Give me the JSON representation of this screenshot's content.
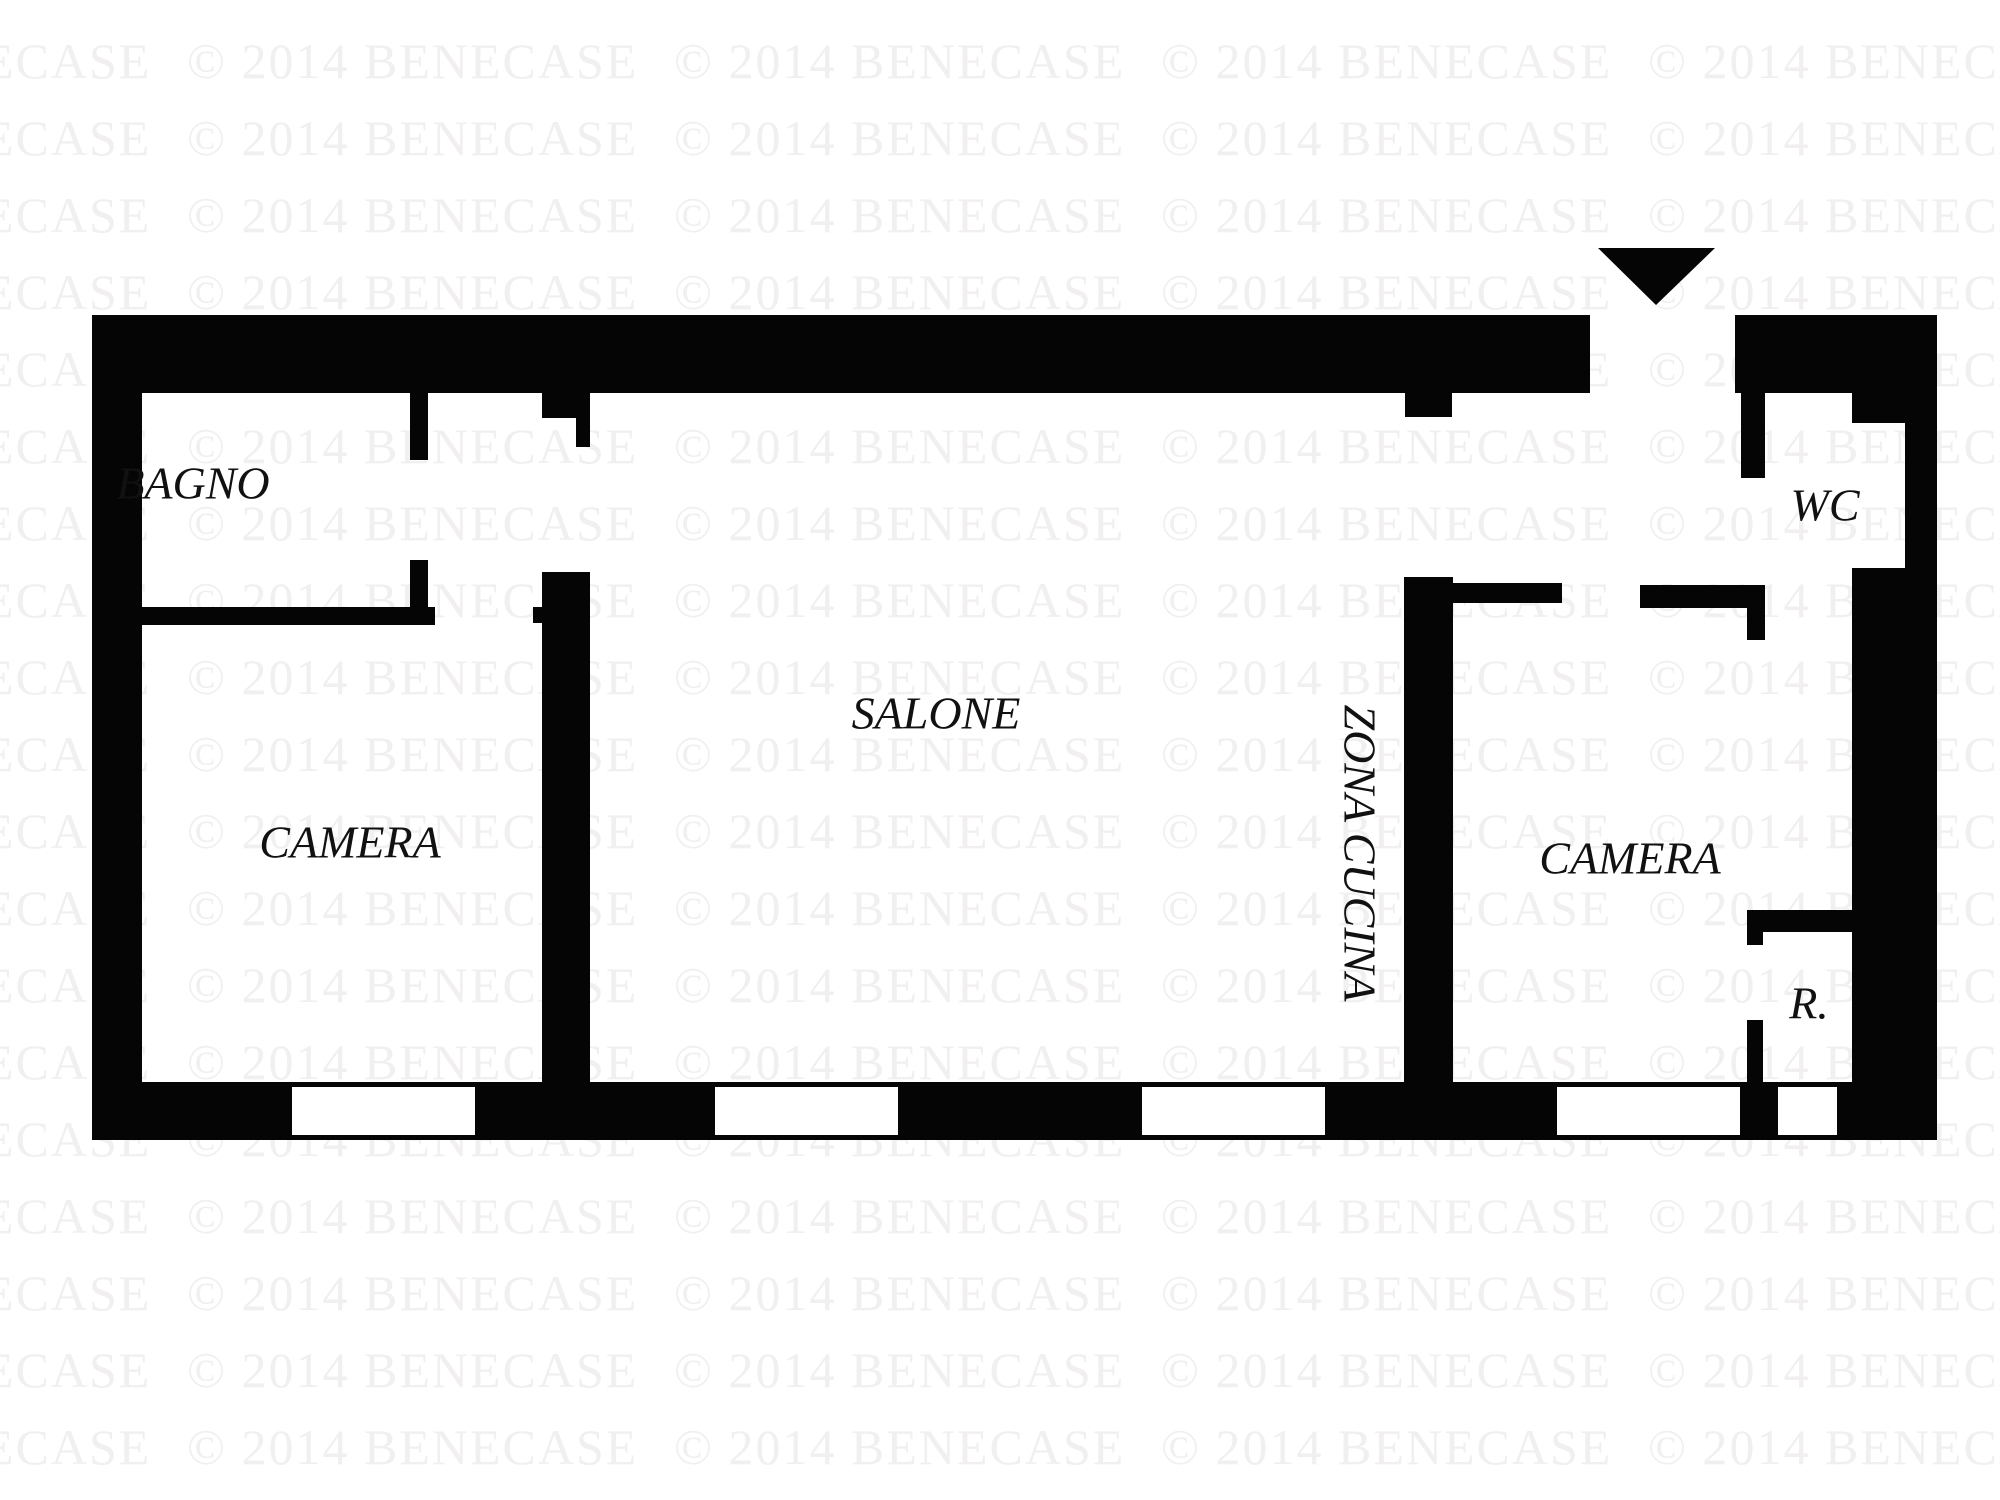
{
  "watermark": {
    "text": "© 2014 BENECASE",
    "color": "#f1efef"
  },
  "plan": {
    "wall_color": "#050505",
    "entrance_arrow": "down-triangle",
    "rooms": {
      "bagno": {
        "label": "BAGNO"
      },
      "camera_left": {
        "label": "CAMERA"
      },
      "salone": {
        "label": "SALONE"
      },
      "zona_cucina": {
        "label": "ZONA CUCINA"
      },
      "camera_right": {
        "label": "CAMERA"
      },
      "wc": {
        "label": "WC"
      },
      "ripostiglio": {
        "label": "R."
      }
    }
  }
}
